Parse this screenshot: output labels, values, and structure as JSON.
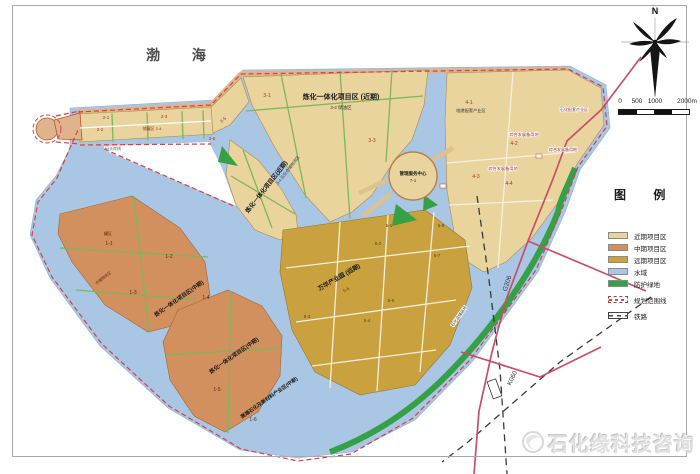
{
  "colors": {
    "near_term": "#e8d49c",
    "mid_term": "#d2905e",
    "long_term": "#c9a13e",
    "water": "#a9c6e5",
    "green": "#35a045",
    "boundary_red": "#d84040",
    "road_red": "#c94f66",
    "railway_black": "#3a3a3a",
    "pier": "#dfb48c"
  },
  "compass": {
    "north_label": "N"
  },
  "scale_bar": {
    "ticks": [
      "0",
      "500",
      "1000",
      "2000m"
    ]
  },
  "legend": {
    "title": "图 例",
    "items": [
      {
        "label": "近期项目区",
        "color": "#e8d49c",
        "type": "solid"
      },
      {
        "label": "中期项目区",
        "color": "#d2905e",
        "type": "solid"
      },
      {
        "label": "远期项目区",
        "color": "#c9a13e",
        "type": "solid"
      },
      {
        "label": "水域",
        "color": "#a9c6e5",
        "type": "solid"
      },
      {
        "label": "防护绿地",
        "color": "#35a045",
        "type": "solid"
      },
      {
        "label": "规划范围线",
        "color": "#d84040",
        "type": "boundary"
      },
      {
        "label": "铁路",
        "color": "#444444",
        "type": "railway"
      }
    ]
  },
  "watermark": {
    "text": "石化缘科技咨询"
  },
  "map": {
    "labels": [
      {
        "text": "渤 海",
        "x": 183,
        "y": 60,
        "fs": 14,
        "color": "#4a4a4a",
        "bold": true,
        "ls": 14,
        "name": "sea-label"
      },
      {
        "text": "炼化一体化项目区 (近期)",
        "x": 341,
        "y": 99,
        "fs": 7,
        "color": "#1a1a1a",
        "bold": true,
        "name": "zone-title-near-term"
      },
      {
        "text": "3-2 储油区",
        "x": 341,
        "y": 109,
        "fs": 4.5,
        "color": "#333333"
      },
      {
        "text": "3-1",
        "x": 267,
        "y": 97,
        "fs": 5,
        "color": "#99342a"
      },
      {
        "text": "3-3",
        "x": 372,
        "y": 142,
        "fs": 5,
        "color": "#99342a"
      },
      {
        "text": "炼化一体化项目区(近期)",
        "x": 268,
        "y": 188,
        "rot": -52,
        "fs": 6,
        "color": "#1a1a1a",
        "bold": true,
        "name": "zone-title-near-term-2"
      },
      {
        "text": "3-4 石化仓储物流区",
        "x": 289,
        "y": 171,
        "rot": -52,
        "fs": 4,
        "color": "#333333"
      },
      {
        "text": "2-1",
        "x": 106,
        "y": 119,
        "fs": 4.5,
        "color": "#99342a"
      },
      {
        "text": "2-2",
        "x": 100,
        "y": 131,
        "fs": 4.5,
        "color": "#99342a"
      },
      {
        "text": "2-3",
        "x": 164,
        "y": 118,
        "fs": 4.5,
        "color": "#99342a"
      },
      {
        "text": "储罐区 2-4",
        "x": 152,
        "y": 130,
        "fs": 4,
        "color": "#99342a"
      },
      {
        "text": "3-5",
        "x": 224,
        "y": 121,
        "rot": -40,
        "fs": 4.5,
        "color": "#99342a"
      },
      {
        "text": "3-6",
        "x": 212,
        "y": 140,
        "fs": 4.5,
        "color": "#99342a"
      },
      {
        "text": "码头岸线",
        "x": 113,
        "y": 150,
        "fs": 4,
        "color": "#555555"
      },
      {
        "text": "4-1",
        "x": 469,
        "y": 104,
        "fs": 5,
        "color": "#99342a"
      },
      {
        "text": "临港配套产业区",
        "x": 471,
        "y": 112,
        "fs": 4.2,
        "color": "#333333"
      },
      {
        "text": "综合发展备用地",
        "x": 524,
        "y": 136,
        "fs": 4.2,
        "color": "#8a2a2a",
        "halo": true
      },
      {
        "text": "4-2",
        "x": 514,
        "y": 145,
        "fs": 5,
        "color": "#99342a"
      },
      {
        "text": "综合发展备用地",
        "x": 503,
        "y": 170,
        "fs": 4.2,
        "color": "#8a2a2a",
        "halo": true
      },
      {
        "text": "4-3",
        "x": 476,
        "y": 178,
        "fs": 5,
        "color": "#99342a"
      },
      {
        "text": "4-4",
        "x": 509,
        "y": 185,
        "fs": 5,
        "color": "#99342a"
      },
      {
        "text": "石化配套产业区",
        "x": 574,
        "y": 111,
        "fs": 4,
        "color": "#8a2a2a",
        "halo": true
      },
      {
        "text": "综合发展备用地",
        "x": 563,
        "y": 151,
        "fs": 4,
        "color": "#8a2a2a",
        "halo": true
      },
      {
        "text": "管理服务中心",
        "x": 413,
        "y": 175,
        "fs": 4.5,
        "color": "#1a1a1a",
        "bold": true,
        "name": "center-island-label"
      },
      {
        "text": "7-1",
        "x": 413,
        "y": 182,
        "fs": 4.5,
        "color": "#333333"
      },
      {
        "text": "罐区",
        "x": 108,
        "y": 235,
        "fs": 4,
        "color": "#5a2a10"
      },
      {
        "text": "1-1",
        "x": 109,
        "y": 245,
        "fs": 5,
        "color": "#5a2a10"
      },
      {
        "text": "1-2",
        "x": 169,
        "y": 258,
        "fs": 5,
        "color": "#5a2a10"
      },
      {
        "text": "仓储物流区",
        "x": 104,
        "y": 279,
        "rot": -38,
        "fs": 3.8,
        "color": "#5a2a10"
      },
      {
        "text": "1-3",
        "x": 133,
        "y": 294,
        "fs": 5,
        "color": "#5a2a10"
      },
      {
        "text": "1-4",
        "x": 206,
        "y": 299,
        "fs": 5,
        "color": "#5a2a10"
      },
      {
        "text": "炼化一体化项目区(中期)",
        "x": 180,
        "y": 300,
        "rot": -35,
        "fs": 5.5,
        "color": "#1a1a1a",
        "bold": true,
        "name": "zone-title-mid-term"
      },
      {
        "text": "炼化一体化项目区(中期)",
        "x": 235,
        "y": 357,
        "rot": -35,
        "fs": 5.5,
        "color": "#1a1a1a",
        "bold": true,
        "name": "zone-title-mid-term-2"
      },
      {
        "text": "高端石化及新材料产业区(中期)",
        "x": 270,
        "y": 399,
        "rot": -35,
        "fs": 5,
        "color": "#1a1a1a",
        "bold": true,
        "name": "zone-title-highend"
      },
      {
        "text": "1-5",
        "x": 217,
        "y": 391,
        "fs": 5,
        "color": "#5a2a10"
      },
      {
        "text": "1-6",
        "x": 253,
        "y": 421,
        "fs": 5,
        "color": "#5a2a10"
      },
      {
        "text": "万华产业园 (远期)",
        "x": 340,
        "y": 279,
        "rot": -30,
        "fs": 6,
        "color": "#1a1a1a",
        "bold": true,
        "name": "zone-title-long-term"
      },
      {
        "text": "5-6",
        "x": 347,
        "y": 291,
        "rot": -30,
        "fs": 4.5,
        "color": "#5a4408"
      },
      {
        "text": "5-1",
        "x": 389,
        "y": 227,
        "fs": 4.5,
        "color": "#5a4408"
      },
      {
        "text": "5-2",
        "x": 378,
        "y": 245,
        "fs": 4.5,
        "color": "#5a4408"
      },
      {
        "text": "5-3",
        "x": 307,
        "y": 318,
        "fs": 4.5,
        "color": "#5a4408"
      },
      {
        "text": "5-4",
        "x": 367,
        "y": 322,
        "fs": 4.5,
        "color": "#5a4408"
      },
      {
        "text": "5-5",
        "x": 391,
        "y": 302,
        "fs": 4.5,
        "color": "#5a4408"
      },
      {
        "text": "5-7",
        "x": 437,
        "y": 257,
        "fs": 4.5,
        "color": "#5a4408"
      },
      {
        "text": "5-8",
        "x": 441,
        "y": 227,
        "fs": 4.5,
        "color": "#5a4408"
      },
      {
        "text": "G206",
        "x": 509,
        "y": 284,
        "rot": -72,
        "fs": 6.5,
        "color": "#333333",
        "name": "road-label-g206"
      },
      {
        "text": "K060",
        "x": 514,
        "y": 379,
        "rot": -65,
        "fs": 6.5,
        "color": "#333333",
        "name": "road-label-k060"
      },
      {
        "text": "石化品储运场",
        "x": 460,
        "y": 317,
        "rot": -55,
        "fs": 4,
        "color": "#333333",
        "halo": true
      }
    ]
  }
}
